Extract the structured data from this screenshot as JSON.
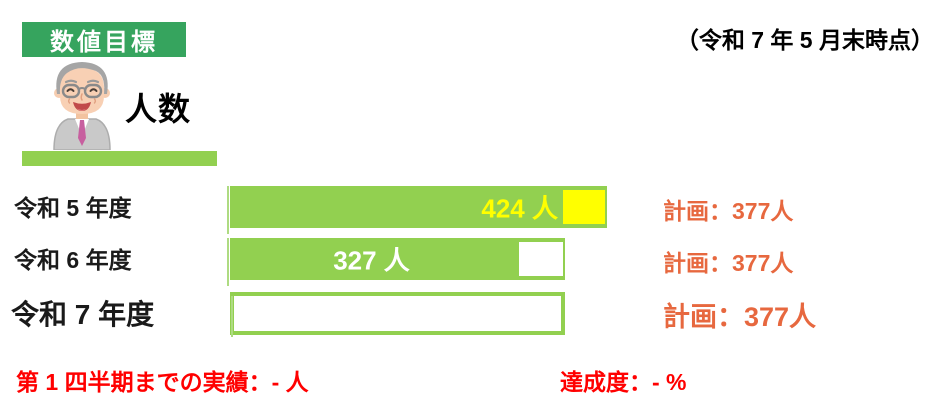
{
  "badge": {
    "label": "数値目標"
  },
  "header": {
    "date_note": "（令和 7 年 5 月末時点）"
  },
  "metric": {
    "title": "人数",
    "icon": "elderly-man-avatar"
  },
  "colors": {
    "badge_green": "#36A45E",
    "bar_green": "#92D050",
    "over_yellow": "#FFFF00",
    "plan_orange": "#E7683F",
    "footer_red": "#FF0000"
  },
  "chart_data": {
    "type": "bar",
    "orientation": "horizontal",
    "unit": "人",
    "plan_value": 377,
    "categories": [
      "令和 5 年度",
      "令和 6 年度",
      "令和 7 年度"
    ],
    "values": [
      424,
      327,
      null
    ],
    "rows": [
      {
        "label": "令和 5 年度",
        "value": 424,
        "value_label": "424 人",
        "plan_label": "計画：377人",
        "status": "over_plan"
      },
      {
        "label": "令和 6 年度",
        "value": 327,
        "value_label": "327 人",
        "plan_label": "計画：377人",
        "status": "under_plan"
      },
      {
        "label": "令和 7 年度",
        "value": null,
        "value_label": "",
        "plan_label": "計画：377人",
        "status": "no_data"
      }
    ]
  },
  "footer": {
    "result_label": "第 1 四半期までの実績：- 人",
    "achievement_label": "達成度：- %"
  }
}
